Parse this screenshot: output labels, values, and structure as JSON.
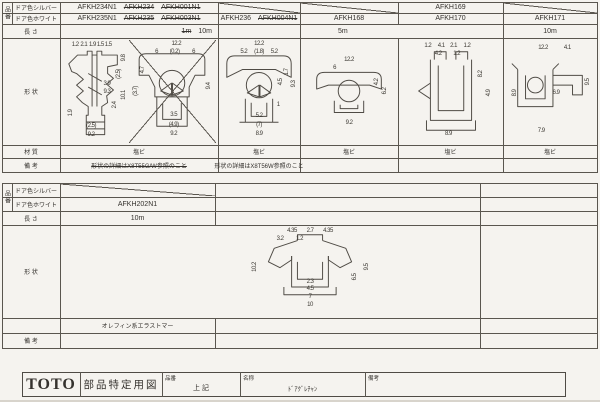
{
  "colors": {
    "paper": "#f5f3ef",
    "line": "#5a564f",
    "text": "#35322e"
  },
  "table1": {
    "part_group_label": "品番",
    "labels": {
      "silver": "ドア色シルバー",
      "white": "ドア色ホワイト",
      "length": "長 さ",
      "shape": "形 状",
      "material": "材 質",
      "remarks": "備 考"
    },
    "silver_row": {
      "c1": [
        {
          "text": "AFKH234N1",
          "struck": false
        },
        {
          "text": "AFKH234",
          "struck": true
        },
        {
          "text": "AFKH001N1",
          "struck": true
        }
      ],
      "c4": "AFKH169"
    },
    "white_row": {
      "c1": [
        {
          "text": "AFKH235N1",
          "struck": false
        },
        {
          "text": "AFKH235",
          "struck": true
        },
        {
          "text": "AFKH003N1",
          "struck": true
        }
      ],
      "c2": [
        {
          "text": "AFKH236",
          "struck": false
        },
        {
          "text": "AFKH004N1",
          "struck": true
        }
      ],
      "c3": "AFKH168",
      "c4": "AFKH170",
      "c5": "AFKH171"
    },
    "length_row": {
      "c1": [
        {
          "text": "1m",
          "struck": true
        },
        {
          "text": "10m",
          "struck": false
        }
      ],
      "c2": "5m",
      "c3": "10m"
    },
    "materials": [
      "塩ビ",
      "塩ビ",
      "塩ビ",
      "塩ビ",
      "塩ビ"
    ],
    "remarks": {
      "c1": "形状の詳細はX8T55G/W参照のこと",
      "c2": "形状の詳細はX8T56W参照のこと"
    }
  },
  "table2": {
    "part_group_label": "品番",
    "labels": {
      "silver": "ドア色シルバー",
      "white": "ドア色ホワイト",
      "length": "長 さ",
      "shape": "形 状",
      "material": "",
      "remarks": "備 考"
    },
    "white_part": "AFKH202N1",
    "length": "10m",
    "material": "オレフィン系エラストマー"
  },
  "drawings": {
    "d1": {
      "dims": [
        {
          "t": "1.2",
          "x": 20,
          "y": 5
        },
        {
          "t": "2.1",
          "x": 33,
          "y": 5
        },
        {
          "t": "1.9",
          "x": 46,
          "y": 5
        },
        {
          "t": "1.5",
          "x": 58,
          "y": 5
        },
        {
          "t": "1.5",
          "x": 70,
          "y": 5
        },
        {
          "t": "9.8",
          "x": 94,
          "y": 18,
          "r": 1
        },
        {
          "t": "(2.5)",
          "x": 86,
          "y": 34,
          "r": 1
        },
        {
          "t": "10.1",
          "x": 94,
          "y": 54,
          "r": 1
        },
        {
          "t": "2.4",
          "x": 80,
          "y": 64,
          "r": 1
        },
        {
          "t": "3.9",
          "x": 68,
          "y": 44
        },
        {
          "t": "9.3",
          "x": 68,
          "y": 51
        },
        {
          "t": "1.9",
          "x": 14,
          "y": 72,
          "r": 1
        },
        {
          "t": "(2.5)",
          "x": 44,
          "y": 85
        },
        {
          "t": "9.2",
          "x": 44,
          "y": 94
        }
      ]
    },
    "d2": {
      "dims": [
        {
          "t": "12.2",
          "x": 55,
          "y": 4
        },
        {
          "t": "6",
          "x": 32,
          "y": 12
        },
        {
          "t": "(0.2)",
          "x": 53,
          "y": 12
        },
        {
          "t": "6",
          "x": 75,
          "y": 12
        },
        {
          "t": "4.7",
          "x": 16,
          "y": 30,
          "r": 1
        },
        {
          "t": "(3.7)",
          "x": 8,
          "y": 50,
          "r": 1
        },
        {
          "t": "9.4",
          "x": 93,
          "y": 46,
          "r": 1
        },
        {
          "t": "3.5",
          "x": 52,
          "y": 74
        },
        {
          "t": "(4.9)",
          "x": 52,
          "y": 84
        },
        {
          "t": "9.2",
          "x": 52,
          "y": 93
        }
      ]
    },
    "d3": {
      "dims": [
        {
          "t": "12.2",
          "x": 50,
          "y": 4
        },
        {
          "t": "5.2",
          "x": 31,
          "y": 12
        },
        {
          "t": "(1.8)",
          "x": 50,
          "y": 12
        },
        {
          "t": "5.2",
          "x": 69,
          "y": 12
        },
        {
          "t": "1.7",
          "x": 85,
          "y": 32,
          "r": 1
        },
        {
          "t": "4.5",
          "x": 78,
          "y": 42,
          "r": 1
        },
        {
          "t": "9.3",
          "x": 94,
          "y": 44,
          "r": 1
        },
        {
          "t": "1",
          "x": 74,
          "y": 64
        },
        {
          "t": "5.2",
          "x": 50,
          "y": 75
        },
        {
          "t": "(7)",
          "x": 50,
          "y": 84
        },
        {
          "t": "8.9",
          "x": 50,
          "y": 93
        }
      ]
    },
    "d4": {
      "dims": [
        {
          "t": "12.2",
          "x": 50,
          "y": 20
        },
        {
          "t": "6",
          "x": 35,
          "y": 28
        },
        {
          "t": "4.2",
          "x": 79,
          "y": 42,
          "r": 1
        },
        {
          "t": "6.2",
          "x": 88,
          "y": 50,
          "r": 1
        },
        {
          "t": "9.2",
          "x": 50,
          "y": 82
        }
      ]
    },
    "d5": {
      "dims": [
        {
          "t": "1.2",
          "x": 28,
          "y": 6
        },
        {
          "t": "4.1",
          "x": 41,
          "y": 6
        },
        {
          "t": "2.1",
          "x": 53,
          "y": 6
        },
        {
          "t": "1.2",
          "x": 66,
          "y": 6
        },
        {
          "t": "4.2",
          "x": 38,
          "y": 14
        },
        {
          "t": "1.2",
          "x": 56,
          "y": 14
        },
        {
          "t": "8.2",
          "x": 80,
          "y": 34,
          "r": 1
        },
        {
          "t": "4.9",
          "x": 87,
          "y": 52,
          "r": 1
        },
        {
          "t": "8.9",
          "x": 48,
          "y": 93
        }
      ]
    },
    "d6": {
      "dims": [
        {
          "t": "12.2",
          "x": 42,
          "y": 8
        },
        {
          "t": "4.1",
          "x": 68,
          "y": 8
        },
        {
          "t": "9.5",
          "x": 90,
          "y": 42,
          "r": 1
        },
        {
          "t": "6.9",
          "x": 56,
          "y": 52
        },
        {
          "t": "8.9",
          "x": 12,
          "y": 52,
          "r": 1
        },
        {
          "t": "7.9",
          "x": 40,
          "y": 90
        }
      ]
    },
    "d7": {
      "dims": [
        {
          "t": "4.35",
          "x": 38,
          "y": 5
        },
        {
          "t": "2.7",
          "x": 50,
          "y": 5
        },
        {
          "t": "4.35",
          "x": 62,
          "y": 5
        },
        {
          "t": "3.2",
          "x": 30,
          "y": 14
        },
        {
          "t": "1.2",
          "x": 43,
          "y": 14
        },
        {
          "t": "10.2",
          "x": 13,
          "y": 45,
          "r": 1
        },
        {
          "t": "9.5",
          "x": 88,
          "y": 45,
          "r": 1
        },
        {
          "t": "6.5",
          "x": 80,
          "y": 56,
          "r": 1
        },
        {
          "t": "2.3",
          "x": 50,
          "y": 62
        },
        {
          "t": "4.5",
          "x": 50,
          "y": 70
        },
        {
          "t": "7",
          "x": 50,
          "y": 79
        },
        {
          "t": "10",
          "x": 50,
          "y": 88
        }
      ]
    }
  },
  "titleblock": {
    "logo": "TOTO",
    "doc_title": "部品特定用図",
    "part_label": "品番",
    "part_value": "上 記",
    "name_label": "名称",
    "name_value": "ﾄﾞｱｸﾞﾚﾁｬﾝ",
    "remarks_label": "備考"
  }
}
